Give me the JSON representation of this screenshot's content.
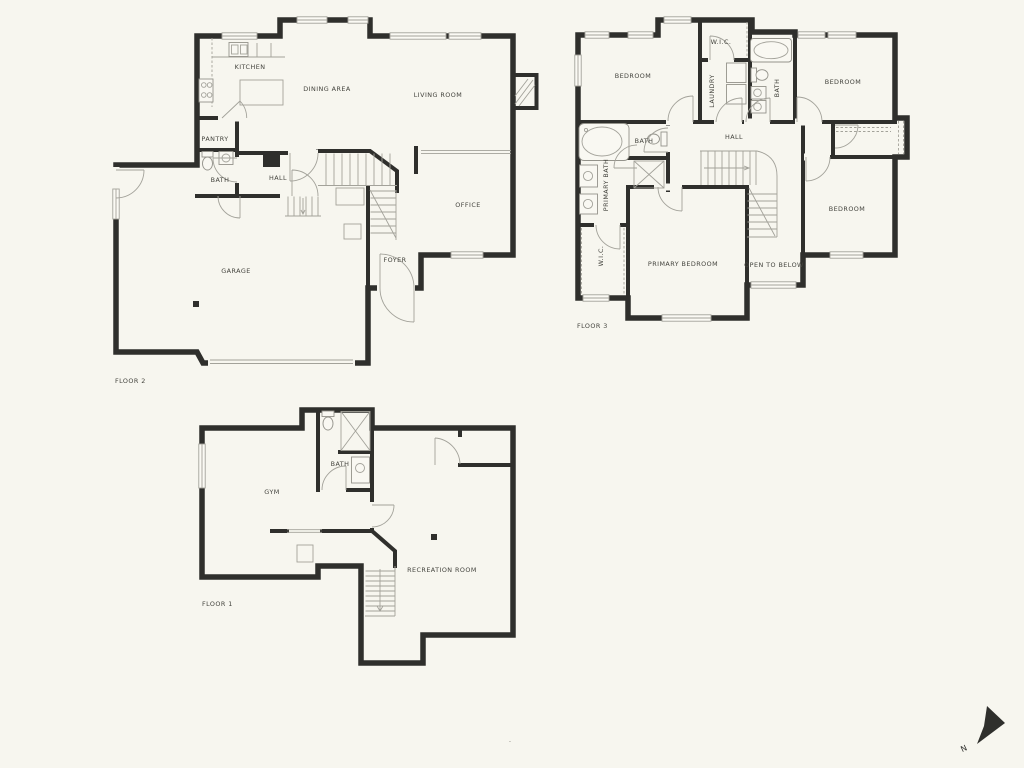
{
  "document": {
    "type": "residential floor plan, 3 floors"
  },
  "colors": {
    "background": "#f7f6ef",
    "wall": "#2f2f2c",
    "thin_line": "#a3a29a",
    "label_text": "#44443e"
  },
  "floors": {
    "floor2": {
      "name": "FLOOR 2",
      "rooms": {
        "kitchen": "KITCHEN",
        "dining_area": "DINING AREA",
        "living_room": "LIVING ROOM",
        "pantry": "PANTRY",
        "bath": "BATH",
        "hall": "HALL",
        "office": "OFFICE",
        "foyer": "FOYER",
        "garage": "GARAGE"
      }
    },
    "floor3": {
      "name": "FLOOR 3",
      "rooms": {
        "bedroom_top_left": "BEDROOM",
        "wic_top": "W.I.C.",
        "laundry": "LAUNDRY",
        "bath_top": "BATH",
        "bedroom_top_right": "BEDROOM",
        "hall": "HALL",
        "bath_mid": "BATH",
        "primary_bath": "PRIMARY BATH",
        "wic_left": "W.I.C.",
        "primary_bedroom": "PRIMARY BEDROOM",
        "open_to_below": "OPEN TO BELOW",
        "bedroom_bottom_right": "BEDROOM"
      }
    },
    "floor1": {
      "name": "FLOOR 1",
      "rooms": {
        "gym": "GYM",
        "bath": "BATH",
        "recreation_room": "RECREATION ROOM"
      }
    }
  },
  "compass": {
    "north_label": "N"
  },
  "watermark": "-"
}
